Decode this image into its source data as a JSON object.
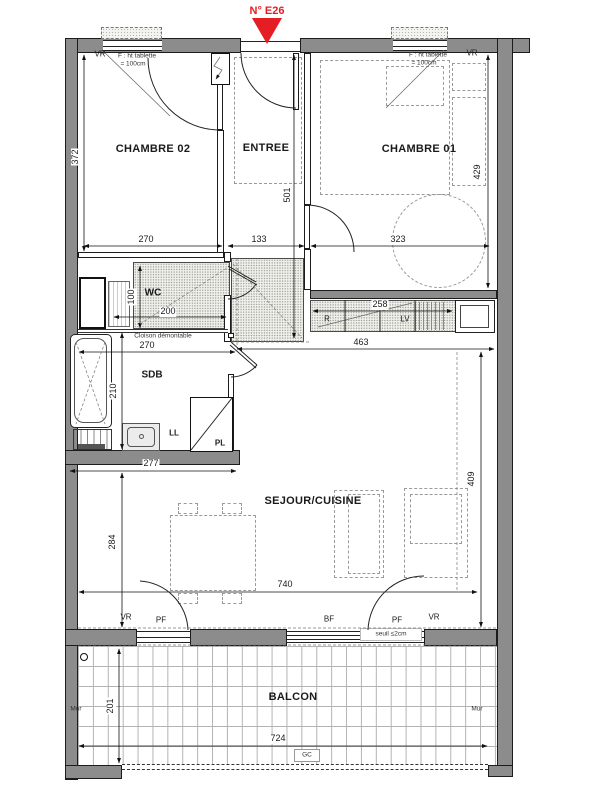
{
  "marker": {
    "unit_label": "N° E26",
    "color": "#e51e25"
  },
  "rooms": {
    "chambre02": "CHAMBRE 02",
    "entree": "ENTREE",
    "chambre01": "CHAMBRE 01",
    "wc": "WC",
    "sdb": "SDB",
    "sejour_cuisine": "SEJOUR/CUISINE",
    "balcon": "BALCON"
  },
  "labels": {
    "vr": "VR",
    "pf": "PF",
    "bf": "BF",
    "mur": "Mur",
    "gc": "GC",
    "washing_machine": "LL",
    "closet": "PL",
    "fridge": "R",
    "dishwasher": "LV",
    "window_note_1": "F : ht tablette",
    "window_note_2": "= 100cm",
    "partition_note": "Cloison démontable",
    "threshold_note": "seuil ≤2cm"
  },
  "dims": {
    "chambre02_width": "270",
    "chambre02_depth": "372",
    "entree_width": "133",
    "entree_depth": "501",
    "chambre01_width": "323",
    "chambre01_depth": "429",
    "wc_depth": "100",
    "wc_width": "200",
    "sdb_width": "270",
    "sdb_depth": "210",
    "kitchen_counter_len": "258",
    "kitchen_zone_width": "463",
    "sejour_alcove_width": "277",
    "sejour_alcove_depth": "284",
    "sejour_width": "740",
    "sejour_depth": "409",
    "balcon_depth": "201",
    "balcon_width": "724"
  }
}
